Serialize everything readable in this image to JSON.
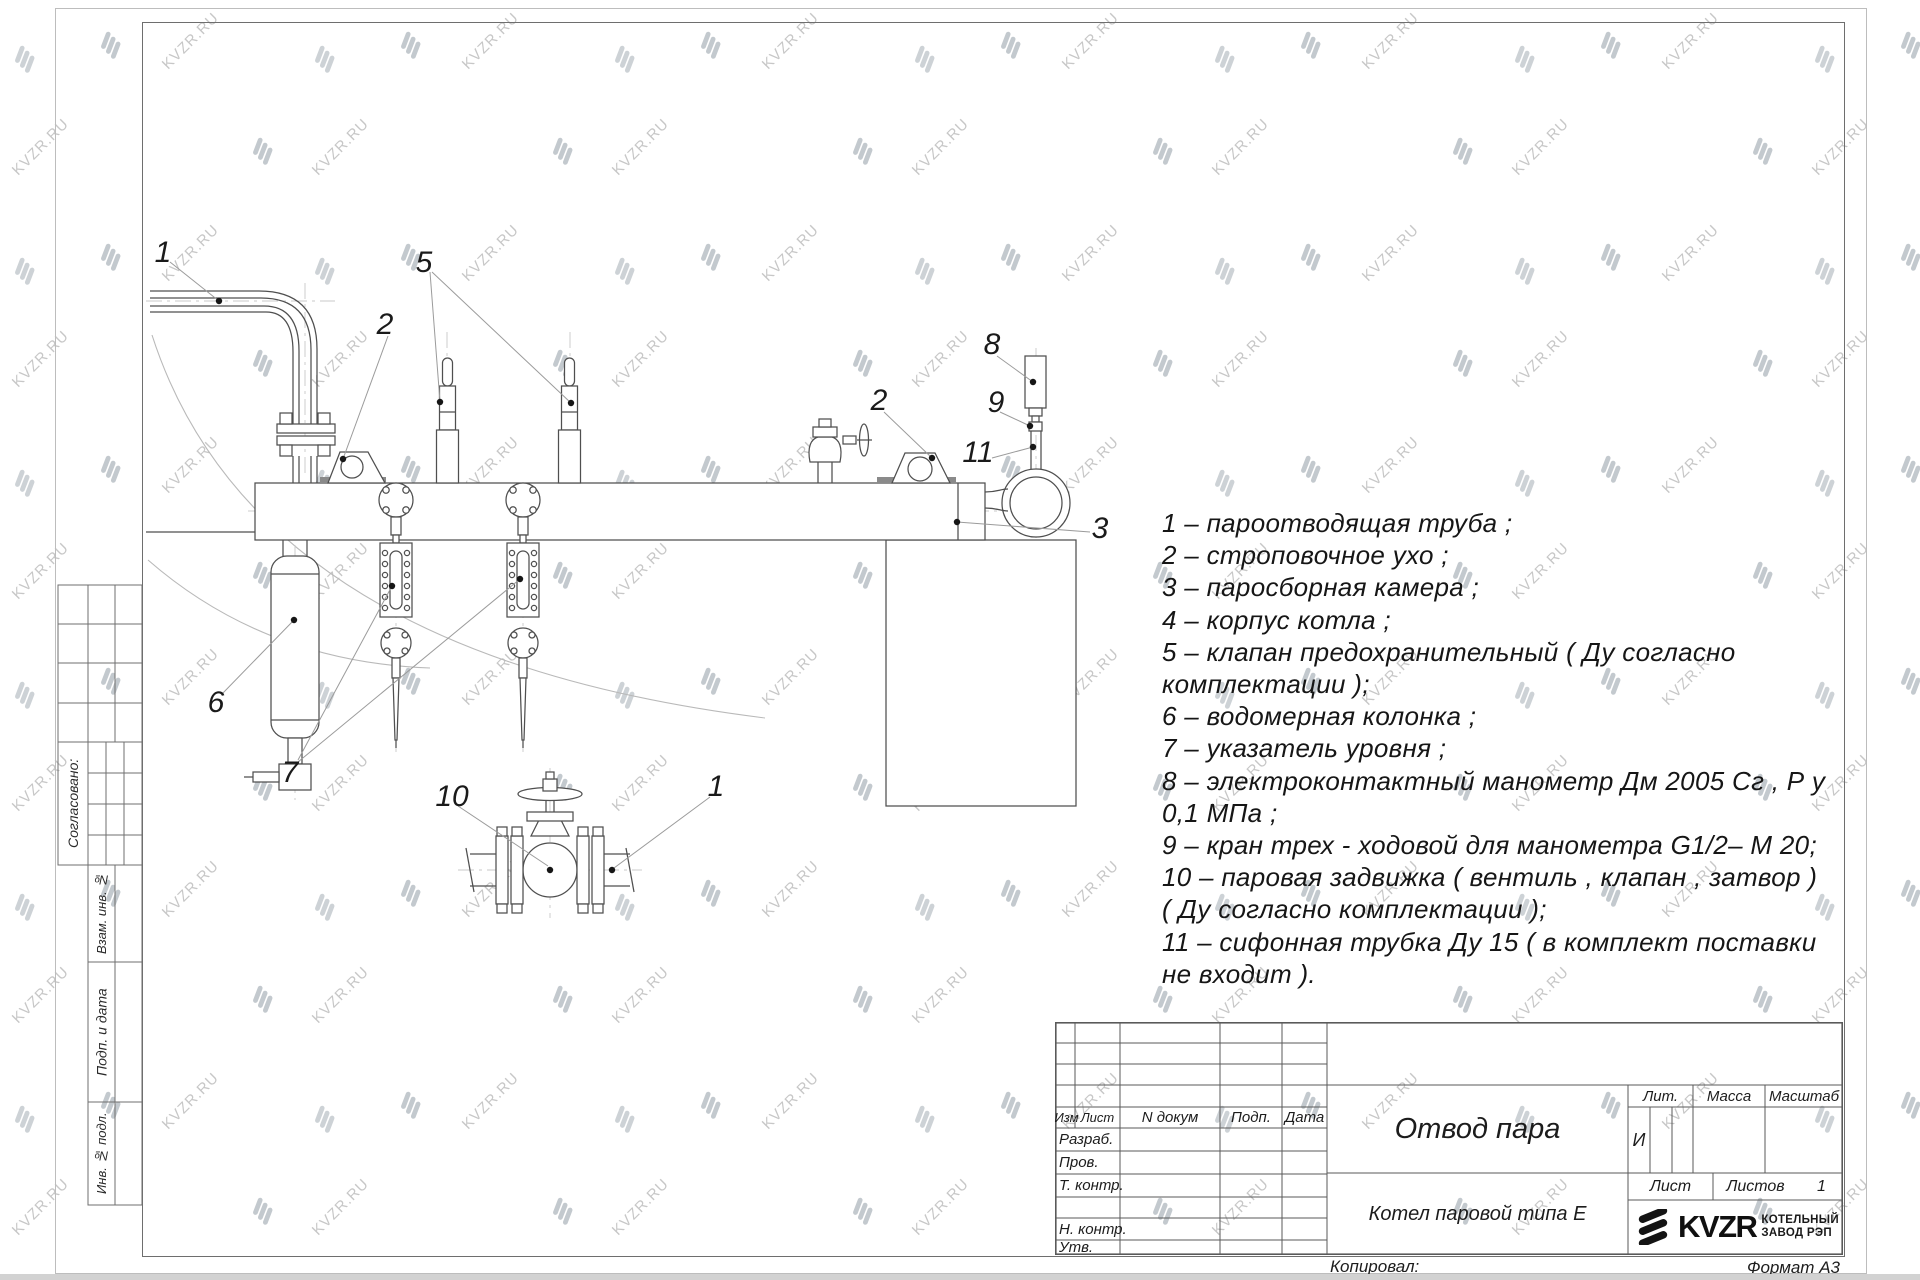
{
  "watermark": {
    "text": "KVZR.RU"
  },
  "legend": {
    "lines": [
      "1 –  пароотводящая труба ;",
      "2 –  строповочное ухо ;",
      "3 –  паросборная камера ;",
      "4 –  корпус котла ;",
      "5 –  клапан предохранительный  ( Ду согласно",
      "комплектации );",
      "6 –  водомерная колонка ;",
      "7 – указатель уровня ;",
      "8 – электроконтактный манометр  Дм 2005 Сг ,  Р у",
      "0,1  МПа ;",
      "9 –  кран трех - ходовой для манометра   G1/2– М 20;",
      "10 –  паровая задвижка  ( вентиль ,  клапан ,  затвор )",
      "( Ду согласно комплектации );",
      "11 –  сифонная трубка Ду 15 ( в комплект поставки",
      "не входит )."
    ]
  },
  "drawing": {
    "callouts": [
      "1",
      "5",
      "2",
      "2",
      "8",
      "9",
      "11",
      "3",
      "6",
      "7",
      "10",
      "1"
    ]
  },
  "side_panel": {
    "agreed": "Согласовано:",
    "vzam": "Взам. инв. №",
    "podp": "Подп. и дата",
    "inv": "Инв. № подл."
  },
  "title_block": {
    "cols": {
      "izm": "Изм",
      "list": "Лист",
      "ndoc": "N докум",
      "podp": "Подп.",
      "data": "Дата"
    },
    "rows": {
      "razrab": "Разраб.",
      "prov": "Пров.",
      "tkontr": "Т. контр.",
      "nkontr": "Н. контр.",
      "utv": "Утв."
    },
    "title": "Отвод пара",
    "product": "Котел паровой типа Е",
    "lit_label": "Лит.",
    "mass_label": "Масса",
    "scale_label": "Масштаб",
    "lit_value": "И",
    "sheet_label": "Лист",
    "sheets_label": "Листов",
    "sheets_count": "1",
    "copied": "Копировал:",
    "format": "Формат А3",
    "logo": {
      "name": "KVZR",
      "line1": "КОТЕЛЬНЫЙ",
      "line2": "ЗАВОД РЭП"
    }
  }
}
